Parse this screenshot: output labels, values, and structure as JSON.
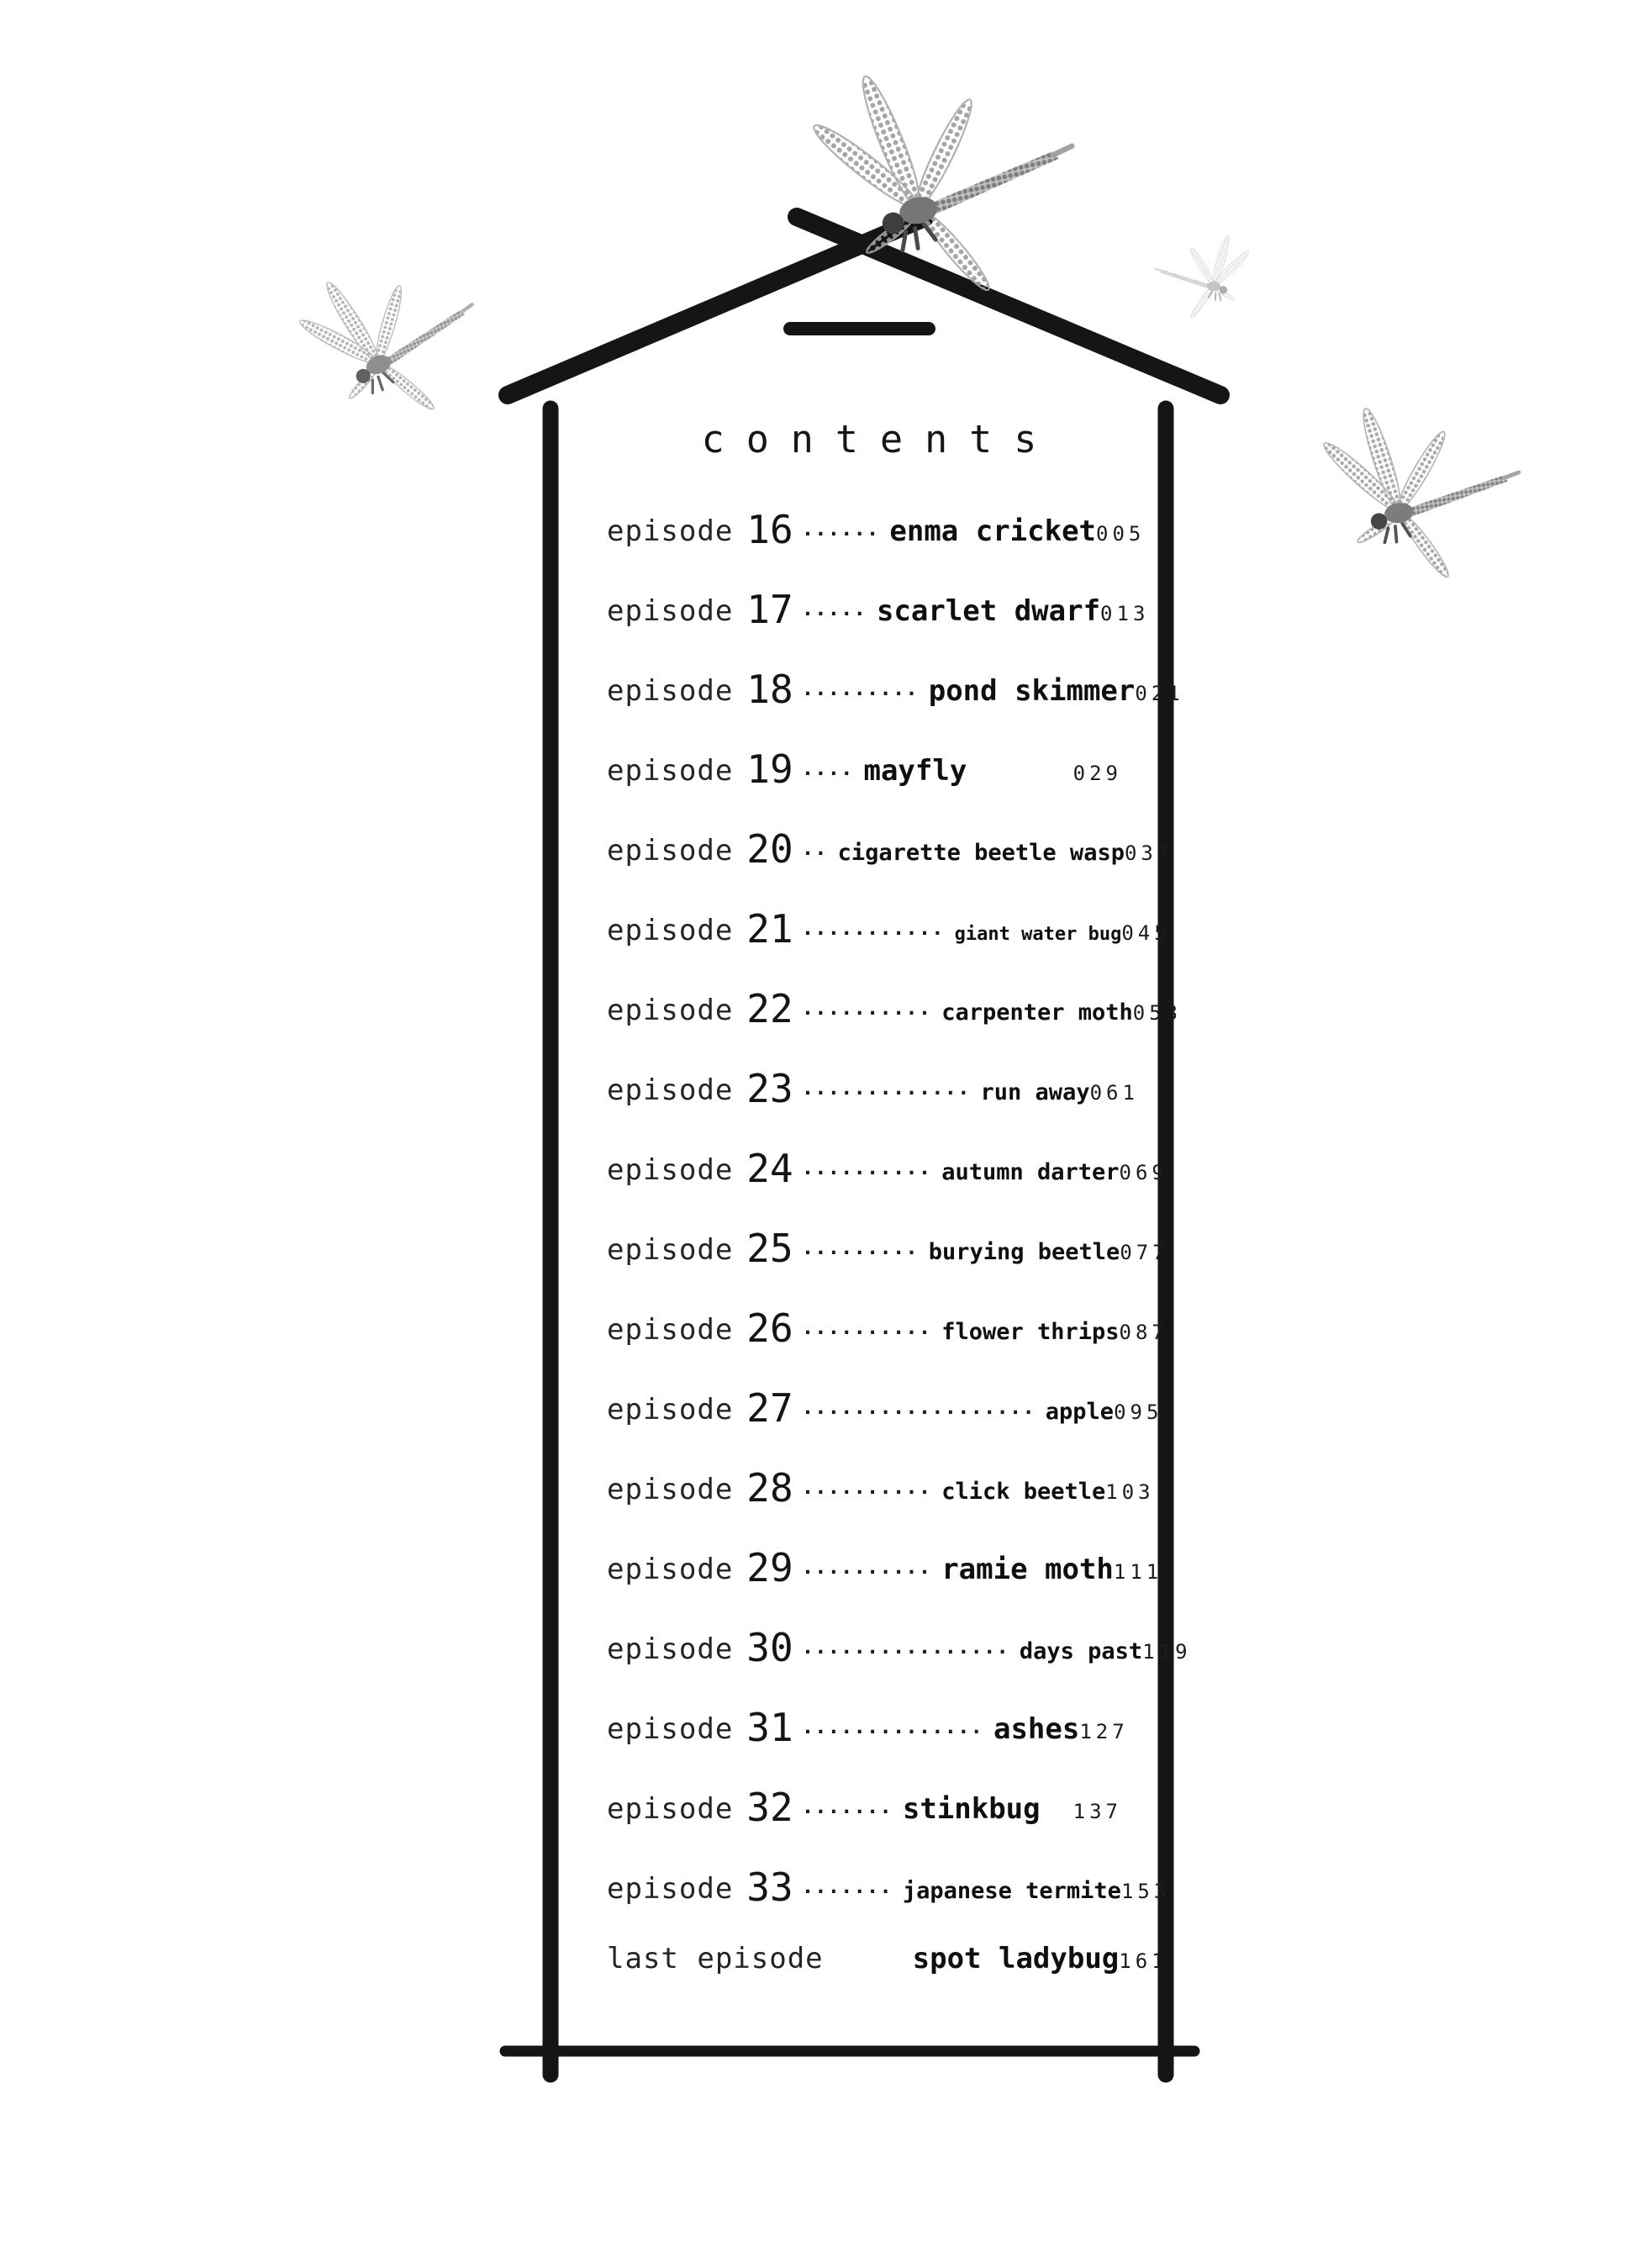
{
  "page": {
    "title": "contents",
    "background_color": "#ffffff",
    "ink_color": "#151515",
    "dragonfly_color": "#9c9c9c"
  },
  "toc": {
    "episodes": [
      {
        "label": "episode",
        "number": "16",
        "leader": "······",
        "title": "enma cricket",
        "page": "005",
        "size": "lg"
      },
      {
        "label": "episode",
        "number": "17",
        "leader": "·····",
        "title": "scarlet dwarf",
        "page": "013",
        "size": "lg"
      },
      {
        "label": "episode",
        "number": "18",
        "leader": "·········",
        "title": "pond skimmer",
        "page": "021",
        "size": "lg"
      },
      {
        "label": "episode",
        "number": "19",
        "leader": "····",
        "title": "mayfly",
        "page": "029",
        "size": "lg"
      },
      {
        "label": "episode",
        "number": "20",
        "leader": "··",
        "title": "cigarette beetle wasp",
        "page": "037",
        "size": "md"
      },
      {
        "label": "episode",
        "number": "21",
        "leader": "···········",
        "title": "giant water bug",
        "page": "045",
        "size": "sm"
      },
      {
        "label": "episode",
        "number": "22",
        "leader": "··········",
        "title": "carpenter moth",
        "page": "053",
        "size": "md"
      },
      {
        "label": "episode",
        "number": "23",
        "leader": "·············",
        "title": "run away",
        "page": "061",
        "size": "md"
      },
      {
        "label": "episode",
        "number": "24",
        "leader": "··········",
        "title": "autumn darter",
        "page": "069",
        "size": "md"
      },
      {
        "label": "episode",
        "number": "25",
        "leader": "·········",
        "title": "burying beetle",
        "page": "077",
        "size": "md"
      },
      {
        "label": "episode",
        "number": "26",
        "leader": "··········",
        "title": "flower thrips",
        "page": "087",
        "size": "md"
      },
      {
        "label": "episode",
        "number": "27",
        "leader": "··················",
        "title": "apple",
        "page": "095",
        "size": "md"
      },
      {
        "label": "episode",
        "number": "28",
        "leader": "··········",
        "title": "click beetle",
        "page": "103",
        "size": "md"
      },
      {
        "label": "episode",
        "number": "29",
        "leader": "··········",
        "title": "ramie moth",
        "page": "111",
        "size": "lg"
      },
      {
        "label": "episode",
        "number": "30",
        "leader": "················",
        "title": "days past",
        "page": "119",
        "size": "md"
      },
      {
        "label": "episode",
        "number": "31",
        "leader": "··············",
        "title": "ashes",
        "page": "127",
        "size": "lg"
      },
      {
        "label": "episode",
        "number": "32",
        "leader": "·······",
        "title": "stinkbug",
        "page": "137",
        "size": "lg"
      },
      {
        "label": "episode",
        "number": "33",
        "leader": "·······",
        "title": "japanese termite",
        "page": "153",
        "size": "md"
      },
      {
        "label": "last episode",
        "number": "",
        "leader": "",
        "title": "spot ladybug",
        "page": "161",
        "size": "lg"
      }
    ]
  },
  "decorations": {
    "house_icon": "house-outline",
    "dragonflies": [
      {
        "name": "dragonfly-top-icon"
      },
      {
        "name": "dragonfly-upper-right-icon"
      },
      {
        "name": "dragonfly-left-icon"
      },
      {
        "name": "dragonfly-right-icon"
      }
    ]
  }
}
